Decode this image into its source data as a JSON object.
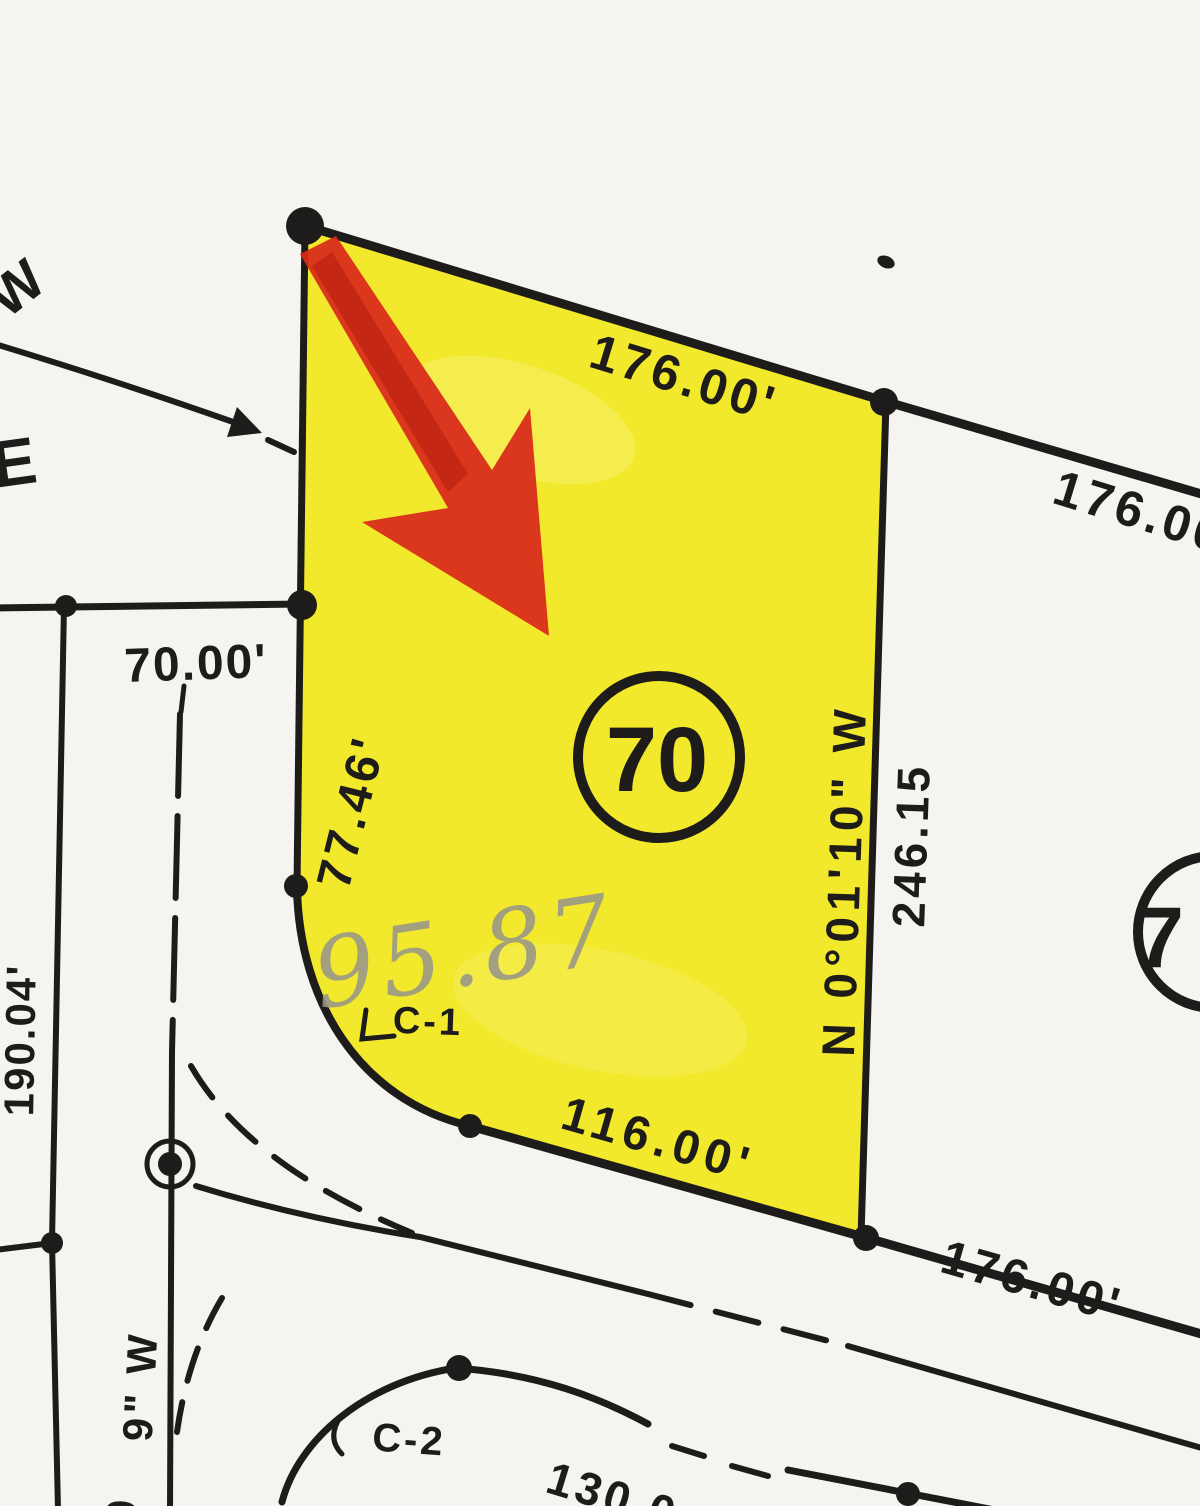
{
  "map": {
    "highlighted_lot": {
      "number": "70",
      "north_length": "176.00'",
      "west_length": "77.46'",
      "east_bearing": "N 0°01'10\" W",
      "east_length": "246.15",
      "south_length": "116.00'",
      "curve_label": "C-1",
      "handwritten_note": "95.87"
    },
    "neighbor_lot": {
      "number_visible": "7"
    },
    "dimensions": {
      "north_continuation": "176.00",
      "south_continuation": "176.00'",
      "west_lot_width": "70.00'",
      "west_lot_depth": "190.04'",
      "south_street_partial": "130.0",
      "bearing_partial": "9\" W",
      "bearing_partial_clipped": "9",
      "curve_label_south": "C-2"
    },
    "street_letters": {
      "top": "W",
      "left": "E"
    }
  },
  "colors": {
    "paper": "#f5f4f1",
    "ink": "#1d1c1a",
    "highlighter_yellow": "#f2e71b",
    "marker_red": "#d8291b",
    "pencil_gray": "#98968a"
  }
}
